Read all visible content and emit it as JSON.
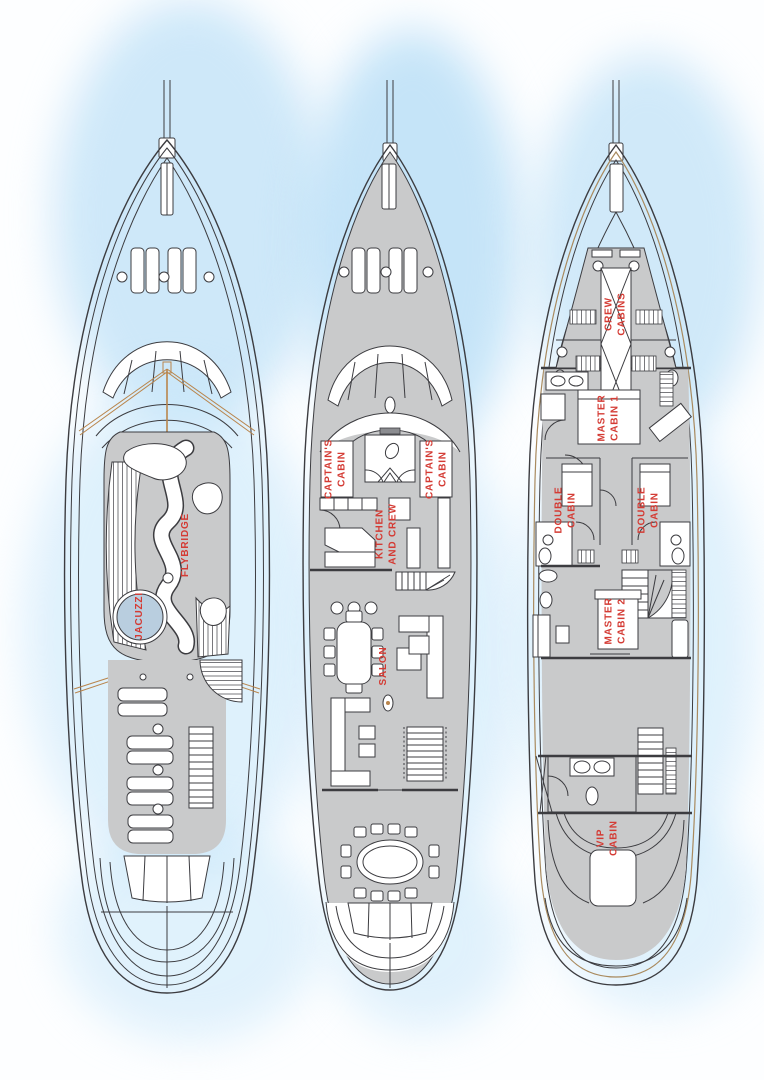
{
  "colors": {
    "label_red": "#d43b34",
    "deck_gray": "#c9cacb",
    "hull_line": "#3c3c40",
    "jacuzzi_blue": "#b9cedf",
    "rigging_tan": "#b9854c",
    "watercolor_blue": "#c9e6f8"
  },
  "decks": {
    "flybridge": {
      "jacuzzi": "JACUZZI",
      "flybridge": "FLYBRIDGE"
    },
    "main": {
      "captains_cabin_port": "CAPTAIN'S\nCABIN",
      "captains_cabin_starboard": "CAPTAIN'S\nCABIN",
      "kitchen_and_crew": "KITCHEN\nAND CREW",
      "salon": "SALON"
    },
    "lower": {
      "crew_cabins": "CREW\nCABINS",
      "master_cabin_1": "MASTER\nCABIN 1",
      "double_cabin_port": "DOUBLE\nCABIN",
      "double_cabin_starboard": "DOUBLE\nCABIN",
      "master_cabin_2": "MASTER\nCABIN 2",
      "vip_cabin": "VIP\nCABIN"
    }
  }
}
